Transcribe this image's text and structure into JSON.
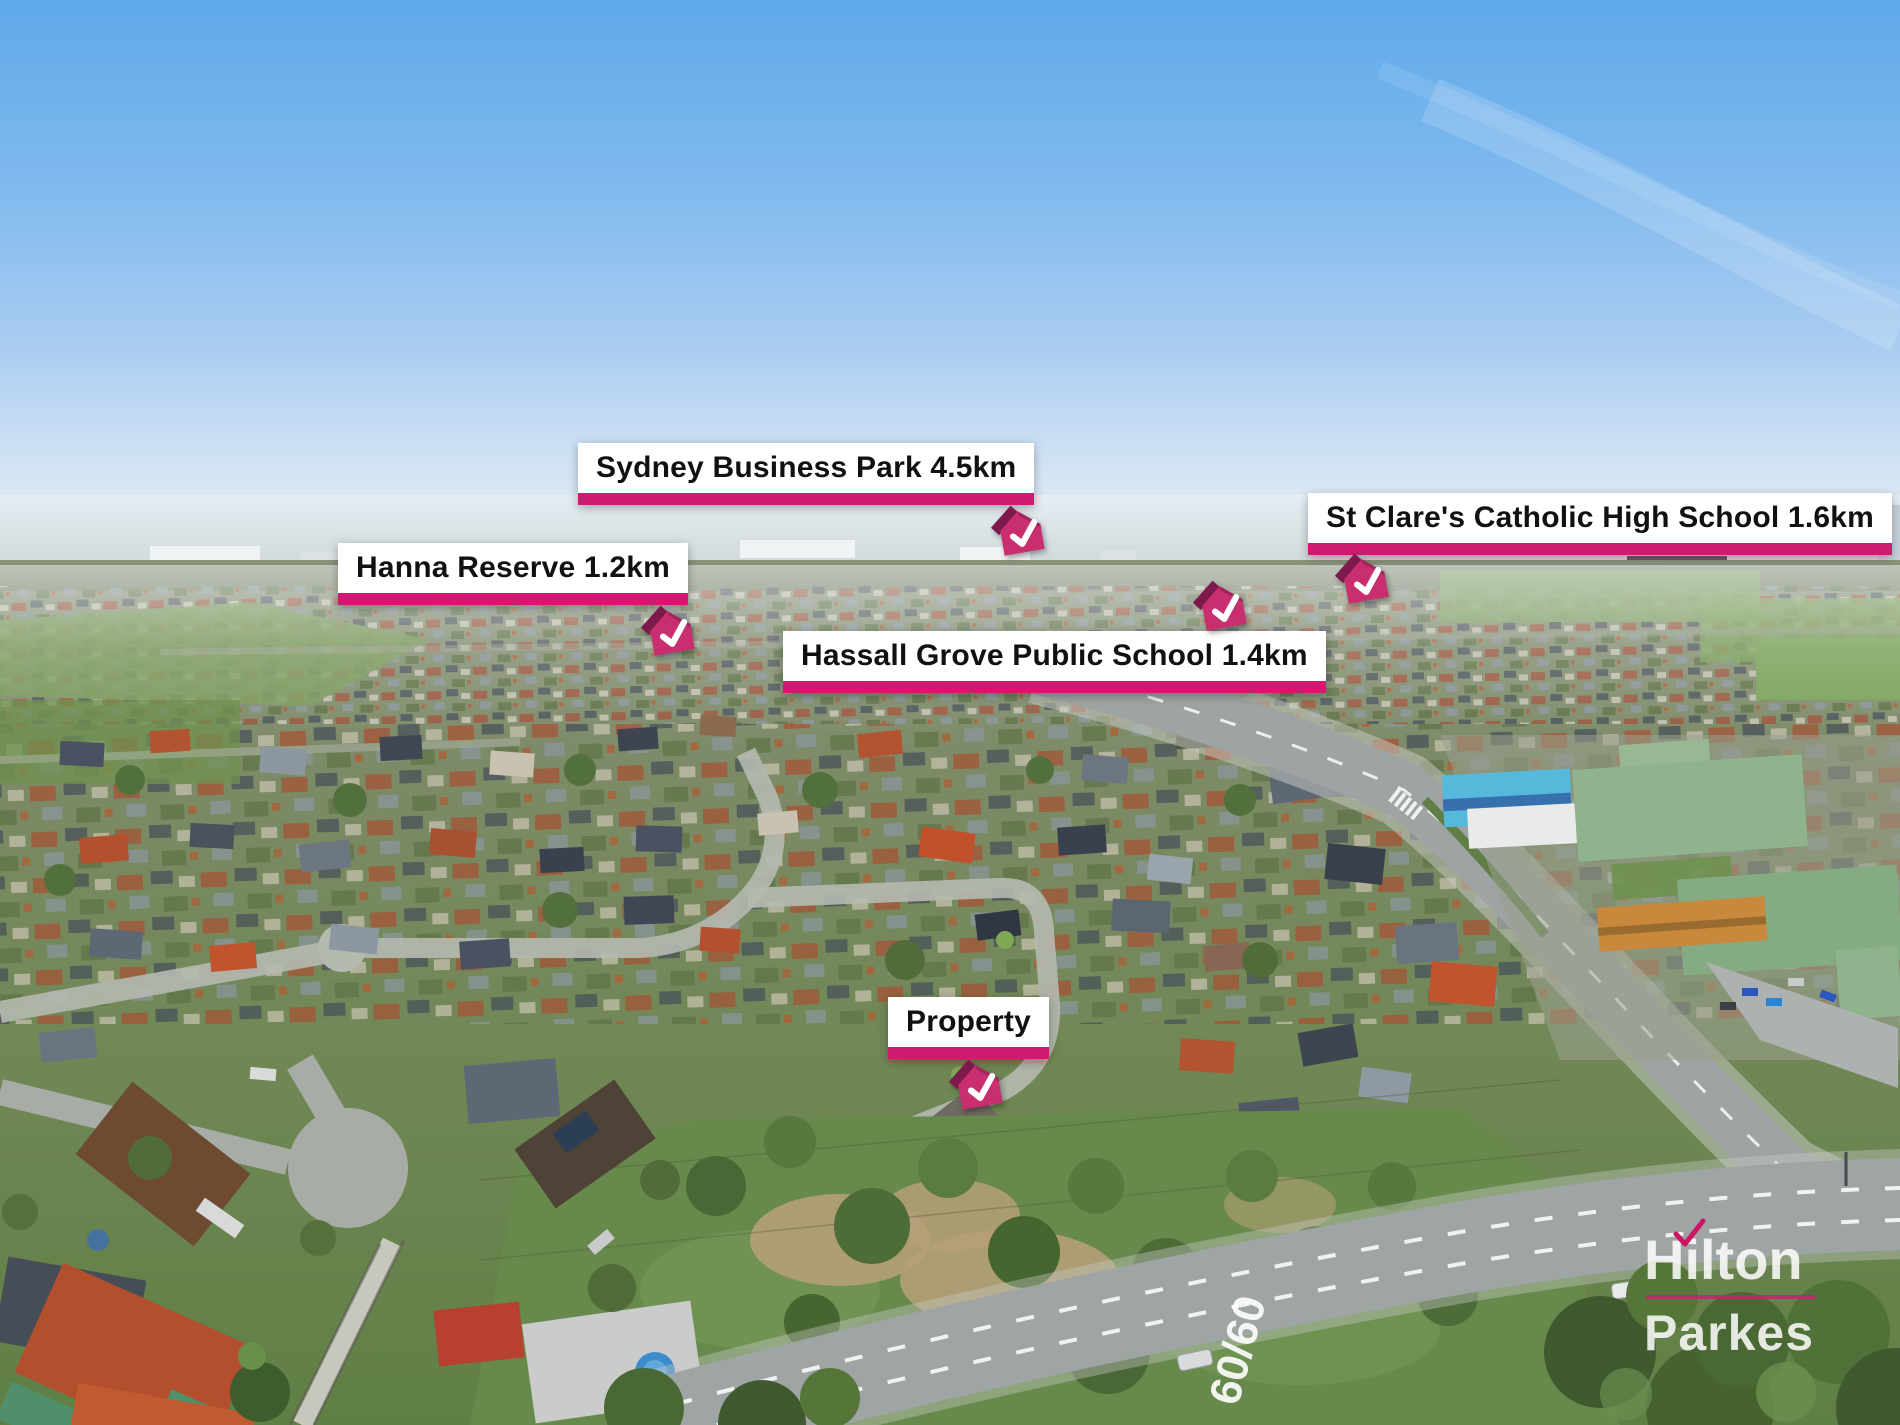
{
  "photo": {
    "road_marking": "60/60"
  },
  "labels": {
    "sydney_business_park": "Sydney Business Park 4.5km",
    "hanna_reserve": "Hanna Reserve 1.2km",
    "st_clares": "St Clare's Catholic High School 1.6km",
    "hassall_grove": "Hassall Grove Public School 1.4km",
    "property": "Property"
  },
  "watermark": {
    "line1": "Hilton",
    "line2": "Parkes"
  },
  "colors": {
    "accent_bar": "#D01A72",
    "marker_front": "#C92E6F",
    "marker_roof": "#7D1A4D",
    "label_background": "#FFFFFF",
    "label_text": "#111111",
    "watermark_text": "#FFFFFF"
  }
}
